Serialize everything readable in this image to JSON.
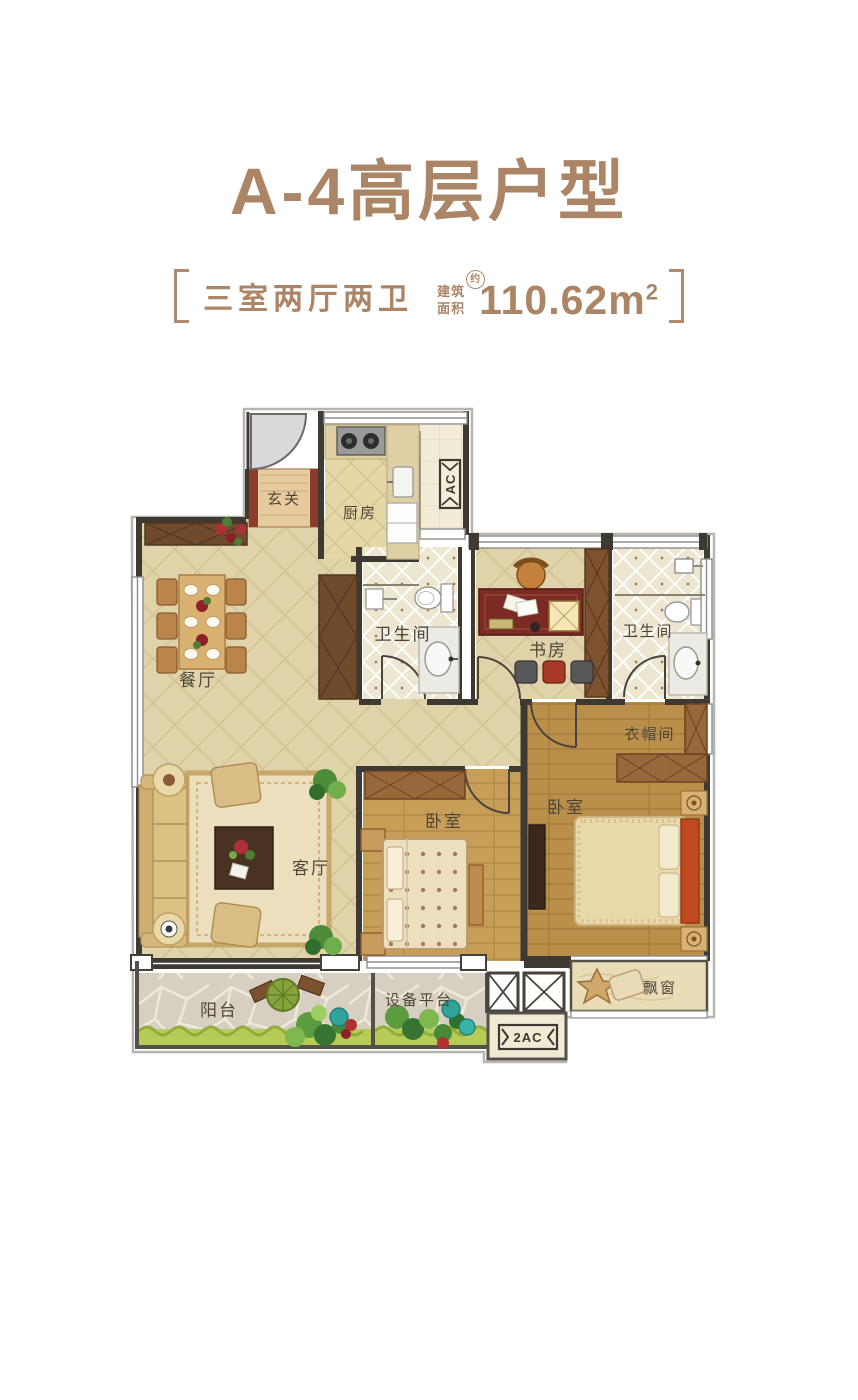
{
  "header": {
    "title": "A-4高层户型",
    "bracket_left": "",
    "bracket_right": "",
    "layout_type": "三室两厅两卫",
    "area_label_top": "建筑",
    "area_label_bottom": "面积",
    "area_approx_badge": "约",
    "area_value": "110.62m",
    "area_superscript": "2"
  },
  "rooms": {
    "foyer": "玄关",
    "kitchen": "厨房",
    "dining": "餐厅",
    "bath_main": "卫生间",
    "study": "书房",
    "bath_master": "卫生间",
    "living": "客厅",
    "bedroom_mid": "卧室",
    "bedroom_master": "卧室",
    "cloakroom": "衣帽间",
    "bay_window": "飘窗",
    "balcony": "阳台",
    "equipment_platform": "设备平台"
  },
  "labels": {
    "ac_shaft": "AC",
    "ac_shaft_2": "2AC"
  },
  "colors": {
    "title_brown": "#ac8566",
    "wall_dark": "#3e3933",
    "floor_tile": "#e1d3a9",
    "floor_wood": "#c69e57",
    "bath_tile": "#ede6d1",
    "grass_green": "#b7cb57",
    "accent_red": "#8d3c2c",
    "balcony_stone": "#d7d0c2"
  }
}
